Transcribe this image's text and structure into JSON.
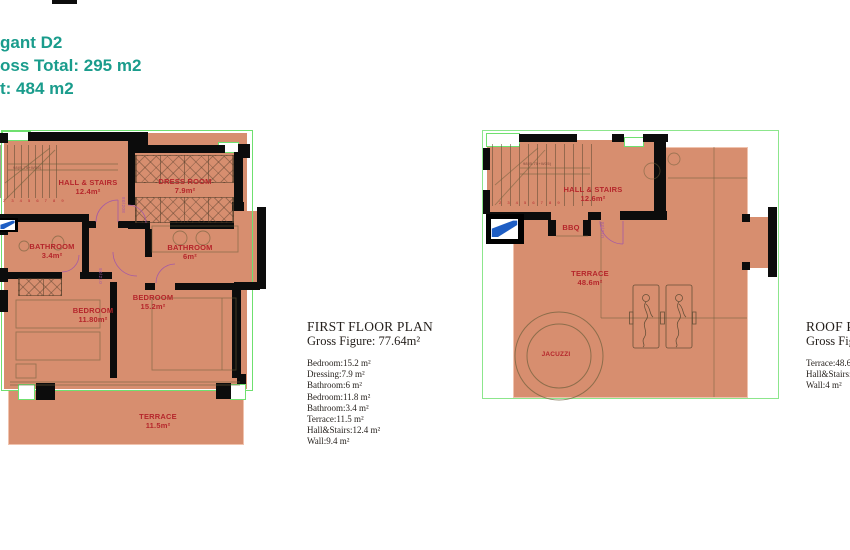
{
  "header": {
    "line1": "gant D2",
    "line2": "oss Total: 295 m2",
    "line3": "t: 484 m2"
  },
  "first_floor": {
    "rooms": {
      "hall": {
        "name": "HALL & STAIRS",
        "area": "12.4m²"
      },
      "dress": {
        "name": "DRESS ROOM",
        "area": "7.9m²"
      },
      "bath_small": {
        "name": "BATHROOM",
        "area": "3.4m²"
      },
      "bath": {
        "name": "BATHROOM",
        "area": "6m²"
      },
      "bedroom_left": {
        "name": "BEDROOM",
        "area": "11.80m²"
      },
      "bedroom_right": {
        "name": "BEDROOM",
        "area": "15.2m²"
      },
      "terrace": {
        "name": "TERRACE",
        "area": "11.5m²"
      }
    },
    "stair_note": "98(B.75+W35)",
    "stair_numbers": "2 3 4 5 6 7 8 9",
    "door_labels": {
      "d1": "80/208",
      "d2": "90/210"
    },
    "info": {
      "title": "FIRST FLOOR PLAN",
      "gross": "Gross Figure: 77.64m²",
      "items": [
        "Bedroom:15.2 m²",
        "Dressing:7.9 m²",
        "Bathroom:6 m²",
        "Bedroom:11.8 m²",
        "Bathroom:3.4 m²",
        "Terrace:11.5 m²",
        "Hall&Stairs:12.4 m²",
        "Wall:9.4 m²"
      ]
    }
  },
  "roof": {
    "rooms": {
      "hall": {
        "name": "HALL & STAIRS",
        "area": "12.6m²"
      },
      "bbq": {
        "name": "BBQ"
      },
      "terrace": {
        "name": "TERRACE",
        "area": "48.6m²"
      },
      "jacuzzi": {
        "name": "JACUZZI"
      }
    },
    "stair_note": "98(B.75+W35)",
    "stair_numbers": "2 3 4 5 6 7 8 9",
    "door_labels": {
      "d1": "80/210"
    },
    "info": {
      "title": "ROOF PLA",
      "gross": "Gross Figu",
      "items": [
        "Terrace:48.6",
        "Hall&Stairs:1",
        "Wall:4 m²"
      ]
    }
  },
  "colors": {
    "accent_teal": "#1a9c8c",
    "floor_fill": "#d78e6f",
    "label_red": "#b5262b",
    "boundary_green": "#6fe06f",
    "swoosh_blue": "#1e5ec4"
  }
}
